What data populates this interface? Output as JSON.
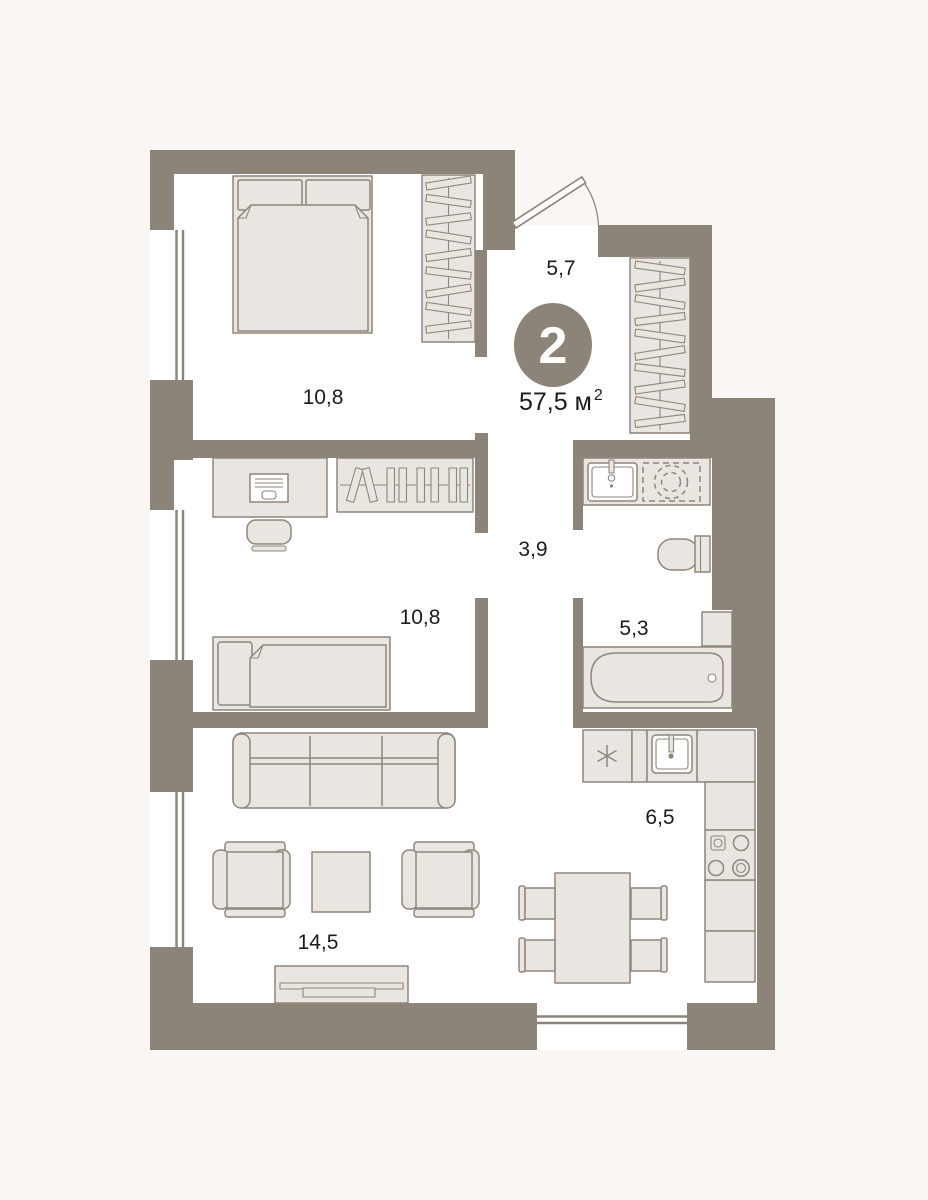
{
  "plan": {
    "badge": {
      "rooms_count": "2"
    },
    "total_area": {
      "value": "57,5",
      "unit": "м",
      "sup": "2"
    },
    "rooms": {
      "entry_hall": {
        "name": "entry-hall",
        "area": "5,7"
      },
      "bedroom_1": {
        "name": "bedroom-1",
        "area": "10,8"
      },
      "corridor": {
        "name": "corridor",
        "area": "3,9"
      },
      "bedroom_2": {
        "name": "bedroom-2",
        "area": "10,8"
      },
      "bathroom": {
        "name": "bathroom",
        "area": "5,3"
      },
      "kitchen": {
        "name": "kitchen-dining",
        "area": "6,5"
      },
      "living_room": {
        "name": "living-room",
        "area": "14,5"
      }
    },
    "colors": {
      "wall": "#8c8379",
      "floor": "#ffffff",
      "background": "#f9f6f3",
      "furniture_fill": "#e9e5e0",
      "furniture_stroke": "#8f867c",
      "text": "#1d1b19",
      "badge_text": "#ffffff"
    }
  }
}
